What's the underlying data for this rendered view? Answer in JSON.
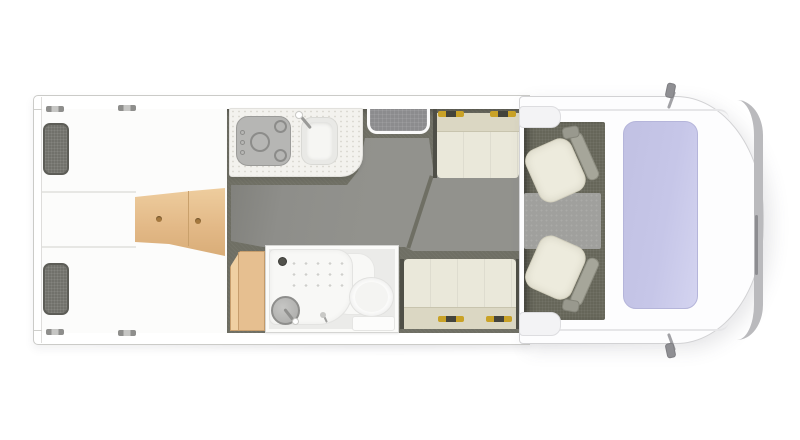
{
  "meta": {
    "title": "Motorhome floor plan - overhead view",
    "diagram_type": "vehicle-layout-floorplan",
    "vehicle_front": "right",
    "vehicle_rear": "left"
  },
  "zones": {
    "rear_bedroom": {
      "label": "Twin single beds",
      "items": [
        "single bed top",
        "single bed bottom",
        "pillow top",
        "pillow bottom",
        "wooden bed steps with two knobs"
      ]
    },
    "kitchen": {
      "label": "Kitchenette",
      "items": [
        "worktop",
        "three-burner hob with three control knobs",
        "sink with faucet"
      ]
    },
    "entry": {
      "label": "Entrance door step mat"
    },
    "wardrobe": {
      "label": "Wooden wardrobe"
    },
    "bathroom": {
      "label": "Washroom",
      "items": [
        "shower tray with drain and anti-slip dots",
        "round washbasin with faucet",
        "toilet with pedestal",
        "small tap"
      ]
    },
    "dinette": {
      "label": "Facing bench seats",
      "items": [
        "rear-facing bench",
        "front-facing bench",
        "gold seat-belt brackets"
      ]
    },
    "cab": {
      "label": "Driver cab",
      "items": [
        "swivel captain seat upper",
        "swivel captain seat lower",
        "cab rug",
        "windshield",
        "side mirror top",
        "side mirror bottom",
        "front bumper"
      ]
    }
  },
  "colors": {
    "body_white": "#ffffff",
    "wall_line": "#cbcbc8",
    "bed_white": "#fcfcfb",
    "pillow": "#71716b",
    "pillow_border": "#5d5d57",
    "wood": "#e6bf90",
    "wood_dark": "#c79e6d",
    "floor_base": "#6f6f64",
    "floor_panel": "#92928d",
    "entry_mat": "#8c8c8e",
    "counter": "#f3f2ee",
    "stove": "#b6b6b4",
    "stove_line": "#8c8c8a",
    "sink": "#e9e9e6",
    "bath_wall": "#fbfbf9",
    "bath_floor": "#ebebe9",
    "shower": "#f8f8f6",
    "basin": "#b0b0ae",
    "cushion": "#eae8da",
    "cushion_dark": "#dbd7c3",
    "bench_side": "#4f4f47",
    "hinge_gold": "#c9a227",
    "cab_carpet": "#666659",
    "cab_rug": "#a0a09d",
    "seat_cream": "#edebdd",
    "seat_gray": "#a6a69a",
    "windshield": "#c6c6e8",
    "windshield_border": "#b5b5da",
    "bumper": "#bababd",
    "mirror": "#8f8f93"
  }
}
